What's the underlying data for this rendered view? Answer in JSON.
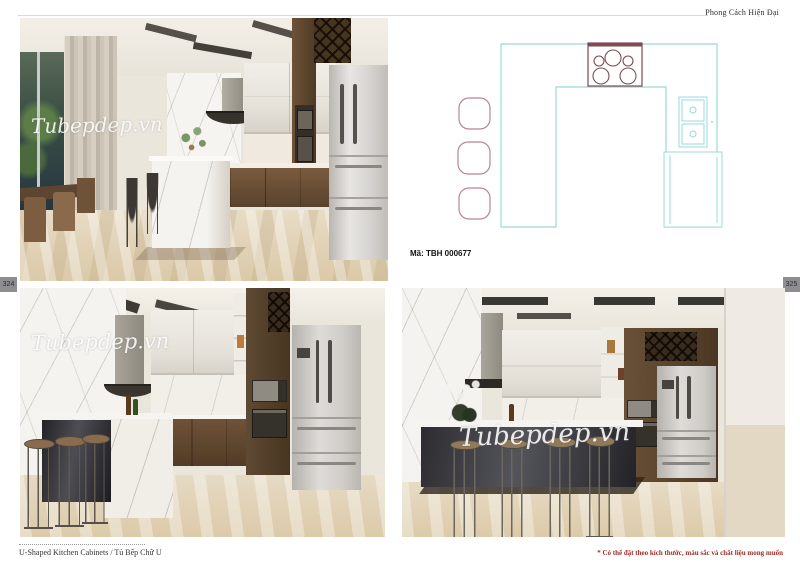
{
  "header": {
    "title": "Phong Cách Hiện Đại"
  },
  "plan": {
    "code": "Mã: TBH 000677",
    "type": "U-shaped kitchen floor plan",
    "stools": 3,
    "burners": 5,
    "appliances": [
      "cooktop",
      "double-oven",
      "refrigerator"
    ]
  },
  "watermark": {
    "text": "Tubepdep.vn"
  },
  "page_numbers": {
    "left": "324",
    "right": "325"
  },
  "footer": {
    "caption": "U-Shaped Kitchen Cabinets /  Tủ Bếp Chữ U",
    "note": "* Có thể đặt theo kích thước, màu sắc và chất liệu mong muốn"
  },
  "colors": {
    "plan_outline": "#9bd8de",
    "plan_stool": "#bb8490",
    "plan_cooktop": "#7d4b52",
    "note_red": "#9e2b25",
    "page_number_bg": "#8e8e91"
  }
}
